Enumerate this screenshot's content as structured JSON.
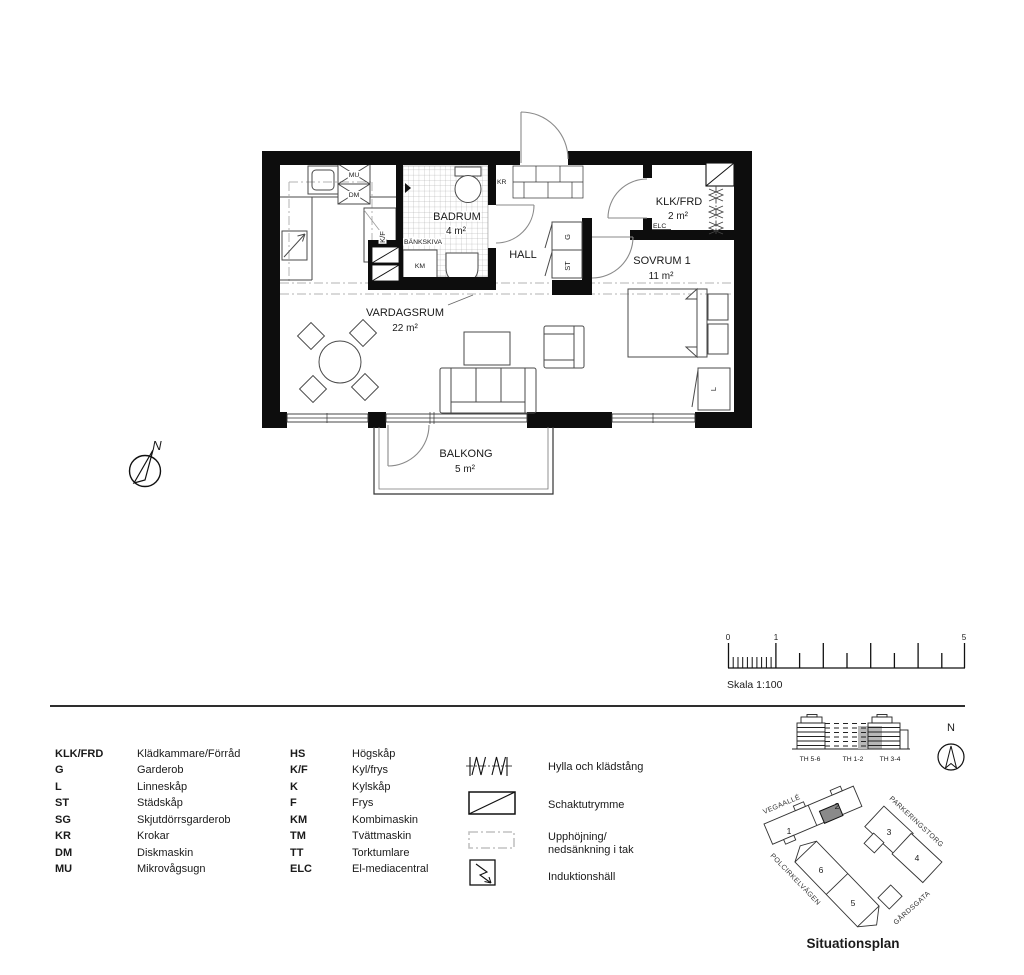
{
  "plan": {
    "rooms": {
      "badrum": {
        "name": "BADRUM",
        "area": "4 m²"
      },
      "hall": {
        "name": "HALL"
      },
      "klk": {
        "name": "KLK/FRD",
        "area": "2 m²"
      },
      "sovrum": {
        "name": "SOVRUM 1",
        "area": "11 m²"
      },
      "vardagsrum": {
        "name": "VARDAGSRUM",
        "area": "22 m²"
      },
      "balkong": {
        "name": "BALKONG",
        "area": "5 m²"
      }
    },
    "fixtures": {
      "mu": "MU",
      "dm": "DM",
      "kf": "K/F",
      "bankskiva": "BÄNKSKIVA",
      "km": "KM",
      "kr": "KR",
      "g": "G",
      "st": "ST",
      "elc": "ELC",
      "l": "L"
    },
    "north_letter": "N"
  },
  "scale_bar": {
    "t0": "0",
    "t1": "1",
    "t5": "5",
    "label": "Skala 1:100"
  },
  "legend": {
    "col1": [
      {
        "abbr": "KLK/FRD",
        "name": "Klädkammare/Förråd"
      },
      {
        "abbr": "G",
        "name": "Garderob"
      },
      {
        "abbr": "L",
        "name": "Linneskåp"
      },
      {
        "abbr": "ST",
        "name": "Städskåp"
      },
      {
        "abbr": "SG",
        "name": "Skjutdörrsgarderob"
      },
      {
        "abbr": "KR",
        "name": "Krokar"
      },
      {
        "abbr": "DM",
        "name": "Diskmaskin"
      },
      {
        "abbr": "MU",
        "name": "Mikrovågsugn"
      }
    ],
    "col2": [
      {
        "abbr": "HS",
        "name": "Högskåp"
      },
      {
        "abbr": "K/F",
        "name": "Kyl/frys"
      },
      {
        "abbr": "K",
        "name": "Kylskåp"
      },
      {
        "abbr": "F",
        "name": "Frys"
      },
      {
        "abbr": "KM",
        "name": "Kombimaskin"
      },
      {
        "abbr": "TM",
        "name": "Tvättmaskin"
      },
      {
        "abbr": "TT",
        "name": "Torktumlare"
      },
      {
        "abbr": "ELC",
        "name": "El-mediacentral"
      }
    ],
    "symbols": {
      "hylla": "Hylla och klädstång",
      "schakt": "Schaktutrymme",
      "tak1": "Upphöjning/",
      "tak2": "nedsänkning i tak",
      "induktion": "Induktionshäll"
    }
  },
  "situation": {
    "elevation": {
      "labels": [
        "TH 5-6",
        "TH 1-2",
        "TH 3-4"
      ]
    },
    "compass_letter": "N",
    "streets": [
      "VEGAALLÉ",
      "PARKERINGSTORG",
      "POLCIRKELVÄGEN",
      "GÅRDSGATA"
    ],
    "buildings": [
      "1",
      "2",
      "3",
      "4",
      "5",
      "6"
    ],
    "title": "Situationsplan"
  }
}
